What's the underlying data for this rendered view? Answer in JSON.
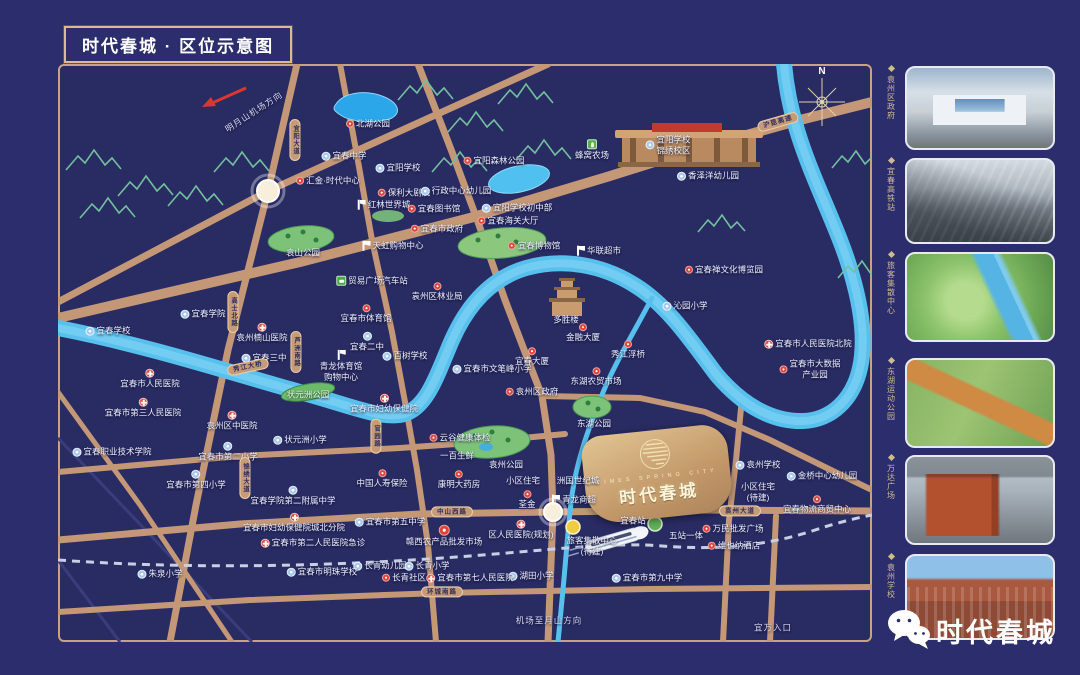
{
  "header": {
    "title": "时代春城 · 区位示意图"
  },
  "map": {
    "compass_n": "N",
    "project": {
      "name": "时代春城",
      "name_en": "TIMES SPRING CITY"
    },
    "labels": [
      {
        "t": "北湖公园",
        "x": 368,
        "y": 124,
        "i": "red"
      },
      {
        "t": "明月山机场方向",
        "x": 254,
        "y": 112,
        "rot": -33,
        "c": "dir"
      },
      {
        "t": "宜春中学",
        "x": 344,
        "y": 156,
        "i": "school"
      },
      {
        "t": "宜阳学校",
        "x": 398,
        "y": 168,
        "i": "school"
      },
      {
        "t": "汇金·时代中心",
        "x": 328,
        "y": 181,
        "i": "red"
      },
      {
        "t": "保利大剧院",
        "x": 404,
        "y": 193,
        "i": "red"
      },
      {
        "t": "行政中心幼儿园",
        "x": 456,
        "y": 191,
        "i": "school"
      },
      {
        "t": "宜阳森林公园",
        "x": 494,
        "y": 161,
        "i": "red"
      },
      {
        "t": "蜂窝农场",
        "x": 592,
        "y": 150,
        "i": "farm",
        "ip": "t"
      },
      {
        "t": "宜阳学校\n锦绣校区",
        "x": 668,
        "y": 145,
        "i": "school"
      },
      {
        "t": "香泽洋幼儿园",
        "x": 708,
        "y": 176,
        "i": "school"
      },
      {
        "t": "红林世界城",
        "x": 383,
        "y": 205,
        "i": "mall"
      },
      {
        "t": "宜春图书馆",
        "x": 434,
        "y": 209,
        "i": "red"
      },
      {
        "t": "宜春市政府",
        "x": 437,
        "y": 229,
        "i": "red"
      },
      {
        "t": "宜阳学校初中部",
        "x": 517,
        "y": 208,
        "i": "school"
      },
      {
        "t": "宜春海关大厅",
        "x": 508,
        "y": 221,
        "i": "red"
      },
      {
        "t": "宜春禅文化博览园",
        "x": 724,
        "y": 270,
        "i": "red"
      },
      {
        "t": "袁山公园",
        "x": 303,
        "y": 253
      },
      {
        "t": "宜春博物馆",
        "x": 534,
        "y": 246,
        "i": "red"
      },
      {
        "t": "天虹购物中心",
        "x": 392,
        "y": 246,
        "i": "mall"
      },
      {
        "t": "贸易广场汽车站",
        "x": 372,
        "y": 281,
        "i": "bus"
      },
      {
        "t": "袁州区林业局",
        "x": 437,
        "y": 292,
        "i": "red",
        "ip": "t"
      },
      {
        "t": "华联超市",
        "x": 598,
        "y": 251,
        "i": "mall"
      },
      {
        "t": "宜春学院",
        "x": 203,
        "y": 314,
        "i": "school"
      },
      {
        "t": "宜春学校",
        "x": 108,
        "y": 331,
        "i": "school"
      },
      {
        "t": "袁州楠山医院",
        "x": 262,
        "y": 333,
        "i": "hosp",
        "ip": "t"
      },
      {
        "t": "宜春三中",
        "x": 264,
        "y": 358,
        "i": "school"
      },
      {
        "t": "宜春市体育馆",
        "x": 366,
        "y": 314,
        "i": "red",
        "ip": "t"
      },
      {
        "t": "宜春二中",
        "x": 367,
        "y": 342,
        "i": "school",
        "ip": "t"
      },
      {
        "t": "青龙体育馆\n购物中心",
        "x": 341,
        "y": 366,
        "i": "mall",
        "ip": "t"
      },
      {
        "t": "宜春市人民医院",
        "x": 150,
        "y": 379,
        "i": "hosp",
        "ip": "t"
      },
      {
        "t": "宜春市第三人民医院",
        "x": 143,
        "y": 408,
        "i": "hosp",
        "ip": "t"
      },
      {
        "t": "袁州区中医院",
        "x": 232,
        "y": 421,
        "i": "hosp",
        "ip": "t"
      },
      {
        "t": "状元洲公园",
        "x": 308,
        "y": 395,
        "c": "park-lbl"
      },
      {
        "t": "百树学校",
        "x": 405,
        "y": 356,
        "i": "school"
      },
      {
        "t": "宜春市文笔峰小学",
        "x": 492,
        "y": 369,
        "i": "school"
      },
      {
        "t": "宜春市妇幼保健院",
        "x": 384,
        "y": 404,
        "i": "hosp",
        "ip": "t"
      },
      {
        "t": "袁州区政府",
        "x": 532,
        "y": 392,
        "i": "red"
      },
      {
        "t": "多胜楼",
        "x": 566,
        "y": 320
      },
      {
        "t": "金融大厦",
        "x": 583,
        "y": 333,
        "i": "red",
        "ip": "t"
      },
      {
        "t": "宜春大厦",
        "x": 532,
        "y": 357,
        "i": "red",
        "ip": "t"
      },
      {
        "t": "秀江浮桥",
        "x": 628,
        "y": 350,
        "i": "red",
        "ip": "t"
      },
      {
        "t": "沁园小学",
        "x": 685,
        "y": 306,
        "i": "school"
      },
      {
        "t": "宜春市人民医院北院",
        "x": 808,
        "y": 344,
        "i": "hosp"
      },
      {
        "t": "宜春市大数据\n产业园",
        "x": 810,
        "y": 369,
        "i": "red"
      },
      {
        "t": "东湖农贸市场",
        "x": 596,
        "y": 377,
        "i": "red",
        "ip": "t"
      },
      {
        "t": "东湖公园",
        "x": 594,
        "y": 424
      },
      {
        "t": "云谷健康体检",
        "x": 460,
        "y": 438,
        "i": "red"
      },
      {
        "t": "一百生鲜",
        "x": 457,
        "y": 456
      },
      {
        "t": "袁州公园",
        "x": 506,
        "y": 465
      },
      {
        "t": "小区住宅",
        "x": 523,
        "y": 481
      },
      {
        "t": "荃金",
        "x": 527,
        "y": 500,
        "i": "red",
        "ip": "t"
      },
      {
        "t": "康明大药房",
        "x": 459,
        "y": 480,
        "i": "red",
        "ip": "t"
      },
      {
        "t": "中国人寿保险",
        "x": 382,
        "y": 479,
        "i": "red",
        "ip": "t"
      },
      {
        "t": "状元洲小学",
        "x": 300,
        "y": 440,
        "i": "school"
      },
      {
        "t": "宜春市第二小学",
        "x": 228,
        "y": 452,
        "i": "school",
        "ip": "t"
      },
      {
        "t": "宜春职业技术学院",
        "x": 112,
        "y": 452,
        "i": "school"
      },
      {
        "t": "宜春市第四小学",
        "x": 196,
        "y": 480,
        "i": "school",
        "ip": "t"
      },
      {
        "t": "宜春学院第二附属中学",
        "x": 293,
        "y": 496,
        "i": "school",
        "ip": "t"
      },
      {
        "t": "宜春市妇幼保健院城北分院",
        "x": 294,
        "y": 523,
        "i": "hosp",
        "ip": "t"
      },
      {
        "t": "宜春市第二人民医院急诊",
        "x": 313,
        "y": 543,
        "i": "hosp"
      },
      {
        "t": "宜春市第五中学",
        "x": 390,
        "y": 522,
        "i": "school"
      },
      {
        "t": "赣西农产品批发市场",
        "x": 444,
        "y": 536,
        "i": "redbig",
        "ip": "t"
      },
      {
        "t": "区人民医院(规划)",
        "x": 521,
        "y": 530,
        "i": "hosp",
        "ip": "t"
      },
      {
        "t": "洲国世纪城",
        "x": 578,
        "y": 481
      },
      {
        "t": "青龙商超",
        "x": 573,
        "y": 500,
        "i": "mall"
      },
      {
        "t": "旅客集散中心\n(待建)",
        "x": 592,
        "y": 546
      },
      {
        "t": "宜春站",
        "x": 633,
        "y": 521
      },
      {
        "t": "五站一体",
        "x": 686,
        "y": 536
      },
      {
        "t": "万民批发广场",
        "x": 733,
        "y": 529,
        "i": "red"
      },
      {
        "t": "维也纳酒店",
        "x": 734,
        "y": 546,
        "i": "red"
      },
      {
        "t": "袁州学校",
        "x": 758,
        "y": 465,
        "i": "school"
      },
      {
        "t": "金桥中心幼儿园",
        "x": 822,
        "y": 476,
        "i": "school"
      },
      {
        "t": "小区住宅\n(待建)",
        "x": 758,
        "y": 492
      },
      {
        "t": "宜春物流商贸中心",
        "x": 817,
        "y": 505,
        "i": "red",
        "ip": "t"
      },
      {
        "t": "宜春市第九中学",
        "x": 647,
        "y": 578,
        "i": "school"
      },
      {
        "t": "湖田小学",
        "x": 531,
        "y": 576,
        "i": "school"
      },
      {
        "t": "长青幼儿园",
        "x": 380,
        "y": 566,
        "i": "school"
      },
      {
        "t": "长青小学",
        "x": 427,
        "y": 566,
        "i": "school"
      },
      {
        "t": "长青社区",
        "x": 404,
        "y": 578,
        "i": "red"
      },
      {
        "t": "宜春市第七人民医院",
        "x": 470,
        "y": 578,
        "i": "hosp"
      },
      {
        "t": "朱泉小学",
        "x": 160,
        "y": 574,
        "i": "school"
      },
      {
        "t": "宜春市明珠学校",
        "x": 322,
        "y": 572,
        "i": "school"
      },
      {
        "t": "机场至月山方向",
        "x": 549,
        "y": 621,
        "c": "dir"
      },
      {
        "t": "宜万入口",
        "x": 773,
        "y": 628,
        "c": "dir"
      }
    ],
    "ovals": [
      {
        "t": "宜阳大道",
        "x": 295,
        "y": 140,
        "v": 1
      },
      {
        "t": "高士北路",
        "x": 233,
        "y": 312,
        "v": 1
      },
      {
        "t": "芦洲南路",
        "x": 296,
        "y": 352,
        "v": 1
      },
      {
        "t": "秀江大桥",
        "x": 248,
        "y": 367,
        "rot": -12
      },
      {
        "t": "官园路",
        "x": 376,
        "y": 436,
        "v": 1
      },
      {
        "t": "锦绣大道",
        "x": 245,
        "y": 478,
        "v": 1
      },
      {
        "t": "中山西路",
        "x": 452,
        "y": 512
      },
      {
        "t": "袁州大道",
        "x": 740,
        "y": 511
      },
      {
        "t": "环城南路",
        "x": 442,
        "y": 592
      },
      {
        "t": "沪昆高速",
        "x": 778,
        "y": 122,
        "rot": -16
      }
    ]
  },
  "sidebar": {
    "items": [
      {
        "label": "袁州区政府"
      },
      {
        "label": "宜春高铁站"
      },
      {
        "label": "旅客集散中心"
      },
      {
        "label": "东湖运动公园"
      },
      {
        "label": "万达广场"
      },
      {
        "label": "袁州学校"
      }
    ]
  },
  "footer": {
    "brand": "时代春城"
  }
}
